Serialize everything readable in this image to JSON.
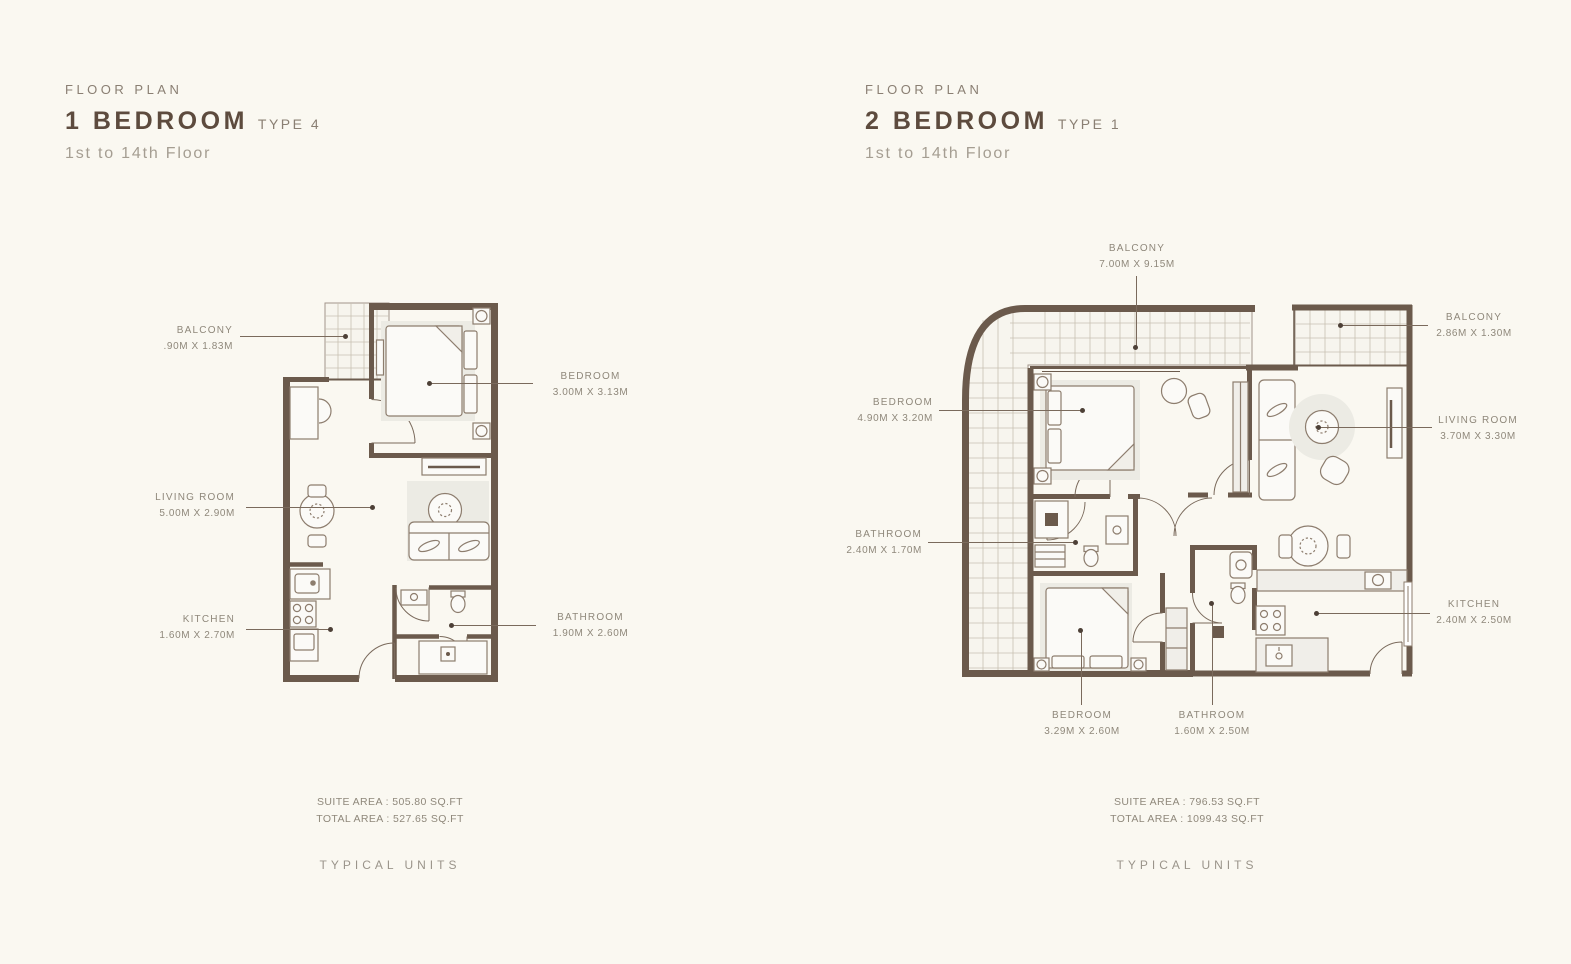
{
  "colors": {
    "background": "#faf8f1",
    "wall": "#6b5a4c",
    "furniture_line": "#8d7d6e",
    "shading": "#ecebe4",
    "title_text": "#5d4b3e",
    "label_text": "#8f887b"
  },
  "plans": [
    {
      "eyebrow": "FLOOR PLAN",
      "title": "1 BEDROOM",
      "variant": "TYPE 4",
      "floors": "1st to 14th Floor",
      "labels": [
        {
          "room": "BALCONY",
          "dims": ".90M X 1.83M"
        },
        {
          "room": "BEDROOM",
          "dims": "3.00M X 3.13M"
        },
        {
          "room": "LIVING ROOM",
          "dims": "5.00M X 2.90M"
        },
        {
          "room": "KITCHEN",
          "dims": "1.60M X 2.70M"
        },
        {
          "room": "BATHROOM",
          "dims": "1.90M X 2.60M"
        }
      ],
      "suite_area": "SUITE AREA : 505.80 SQ.FT",
      "total_area": "TOTAL AREA : 527.65 SQ.FT",
      "footer": "TYPICAL UNITS"
    },
    {
      "eyebrow": "FLOOR PLAN",
      "title": "2 BEDROOM",
      "variant": "TYPE 1",
      "floors": "1st to 14th Floor",
      "labels": [
        {
          "room": "BALCONY",
          "dims": "7.00M X 9.15M"
        },
        {
          "room": "BALCONY",
          "dims": "2.86M X 1.30M"
        },
        {
          "room": "BEDROOM",
          "dims": "4.90M X 3.20M"
        },
        {
          "room": "LIVING ROOM",
          "dims": "3.70M X 3.30M"
        },
        {
          "room": "BATHROOM",
          "dims": "2.40M X 1.70M"
        },
        {
          "room": "KITCHEN",
          "dims": "2.40M X 2.50M"
        },
        {
          "room": "BEDROOM",
          "dims": "3.29M X 2.60M"
        },
        {
          "room": "BATHROOM",
          "dims": "1.60M X 2.50M"
        }
      ],
      "suite_area": "SUITE AREA : 796.53 SQ.FT",
      "total_area": "TOTAL AREA : 1099.43 SQ.FT",
      "footer": "TYPICAL UNITS"
    }
  ]
}
